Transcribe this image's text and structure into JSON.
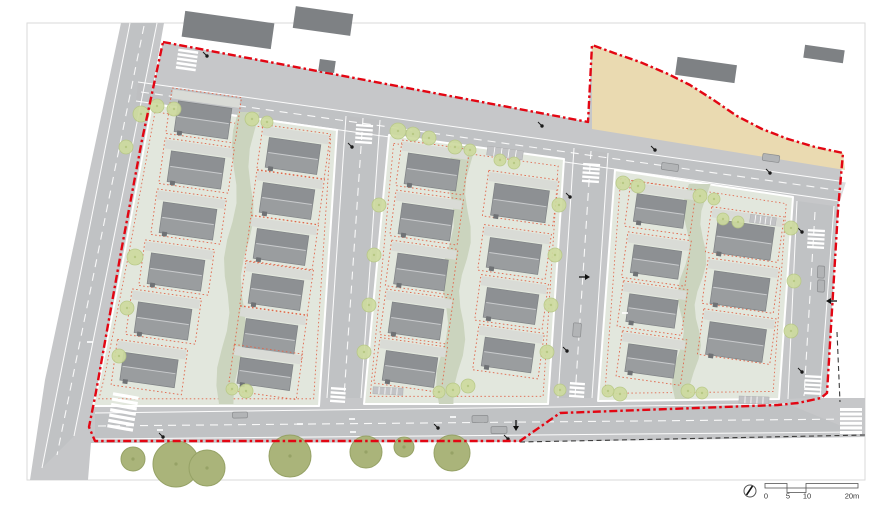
{
  "scale_bar": {
    "labels": [
      "0",
      "5",
      "10",
      "20m"
    ]
  },
  "colors": {
    "boundary_red": "#e30613",
    "plot_red": "#e0654a",
    "road_gray": "#c6c7c9",
    "carriageway_gray": "#bcbdbf",
    "block_green": "#e2e7dd",
    "path_green": "#cbd4be",
    "tree_green": "#cedb9f",
    "big_tree_green": "#aab47a",
    "beige": "#eadab1",
    "building_dark": "#7e8184",
    "driveway_gray": "#d9dbd6",
    "roof_upper": "#8d9093",
    "roof_lower": "#9a9d9f"
  },
  "plan": {
    "houses": [
      [
        203,
        120,
        54,
        31
      ],
      [
        196,
        170,
        54,
        31
      ],
      [
        188,
        221,
        54,
        31
      ],
      [
        176,
        272,
        54,
        31
      ],
      [
        163,
        321,
        54,
        31
      ],
      [
        149,
        370,
        55,
        28
      ],
      [
        293,
        156,
        52,
        30
      ],
      [
        287,
        201,
        52,
        30
      ],
      [
        281,
        247,
        52,
        30
      ],
      [
        276,
        292,
        52,
        30
      ],
      [
        270,
        337,
        52,
        30
      ],
      [
        265,
        374,
        53,
        26
      ],
      [
        432,
        172,
        52,
        31
      ],
      [
        426,
        222,
        52,
        31
      ],
      [
        421,
        272,
        51,
        31
      ],
      [
        416,
        321,
        52,
        31
      ],
      [
        410,
        369,
        52,
        30
      ],
      [
        520,
        203,
        55,
        32
      ],
      [
        514,
        256,
        52,
        30
      ],
      [
        511,
        306,
        52,
        30
      ],
      [
        508,
        355,
        50,
        29
      ],
      [
        660,
        211,
        50,
        28
      ],
      [
        656,
        262,
        48,
        28
      ],
      [
        652,
        311,
        49,
        28
      ],
      [
        651,
        361,
        49,
        28
      ],
      [
        744,
        240,
        57,
        33
      ],
      [
        740,
        291,
        56,
        33
      ],
      [
        736,
        342,
        57,
        33
      ]
    ],
    "trees": [
      [
        141,
        114,
        8
      ],
      [
        126,
        147,
        7
      ],
      [
        135,
        257,
        8
      ],
      [
        127,
        308,
        7
      ],
      [
        119,
        356,
        7
      ],
      [
        157,
        106,
        7
      ],
      [
        174,
        109,
        7
      ],
      [
        252,
        119,
        7
      ],
      [
        267,
        122,
        6
      ],
      [
        246,
        391,
        7
      ],
      [
        232,
        389,
        6
      ],
      [
        398,
        131,
        8
      ],
      [
        413,
        134,
        7
      ],
      [
        429,
        138,
        7
      ],
      [
        455,
        147,
        7
      ],
      [
        470,
        150,
        6
      ],
      [
        379,
        205,
        7
      ],
      [
        374,
        255,
        7
      ],
      [
        369,
        305,
        7
      ],
      [
        364,
        352,
        7
      ],
      [
        559,
        205,
        7
      ],
      [
        555,
        255,
        7
      ],
      [
        551,
        305,
        7
      ],
      [
        547,
        352,
        7
      ],
      [
        468,
        386,
        7
      ],
      [
        453,
        390,
        7
      ],
      [
        439,
        392,
        6
      ],
      [
        500,
        160,
        6
      ],
      [
        514,
        163,
        6
      ],
      [
        623,
        183,
        7
      ],
      [
        638,
        186,
        7
      ],
      [
        700,
        196,
        7
      ],
      [
        714,
        199,
        6
      ],
      [
        620,
        394,
        7
      ],
      [
        688,
        391,
        7
      ],
      [
        702,
        393,
        6
      ],
      [
        560,
        390,
        6
      ],
      [
        608,
        391,
        6
      ],
      [
        791,
        228,
        7
      ],
      [
        794,
        281,
        7
      ],
      [
        791,
        331,
        7
      ],
      [
        723,
        219,
        6
      ],
      [
        738,
        222,
        6
      ]
    ],
    "big_trees": [
      [
        133,
        459,
        12
      ],
      [
        176,
        464,
        23
      ],
      [
        207,
        468,
        18
      ],
      [
        290,
        456,
        21
      ],
      [
        366,
        452,
        16
      ],
      [
        404,
        447,
        10
      ],
      [
        452,
        453,
        18
      ]
    ],
    "lamps": [
      [
        207,
        56
      ],
      [
        542,
        126
      ],
      [
        655,
        150
      ],
      [
        770,
        173
      ],
      [
        802,
        232
      ],
      [
        802,
        372
      ],
      [
        570,
        197
      ],
      [
        567,
        351
      ],
      [
        508,
        439
      ],
      [
        163,
        437
      ],
      [
        438,
        428
      ],
      [
        352,
        147
      ]
    ],
    "cars": [
      [
        670,
        167,
        17,
        7,
        8
      ],
      [
        771,
        158,
        17,
        7,
        8
      ],
      [
        577,
        330,
        8,
        14,
        4
      ],
      [
        821,
        272,
        7,
        12,
        3
      ],
      [
        821,
        286,
        7,
        12,
        3
      ],
      [
        480,
        419,
        16,
        7,
        -1
      ],
      [
        499,
        430,
        16,
        7,
        -1
      ],
      [
        240,
        415,
        15,
        6,
        -1
      ]
    ],
    "crosswalks": [
      [
        187,
        60,
        5,
        20,
        2.6,
        4.4,
        8
      ],
      [
        364,
        134,
        5,
        17,
        2.4,
        4.2,
        4
      ],
      [
        591,
        173,
        5,
        17,
        2.4,
        4.2,
        4
      ],
      [
        816,
        239,
        5,
        17,
        2.4,
        4.2,
        3
      ],
      [
        813,
        385,
        5,
        17,
        2.4,
        4.2,
        3
      ],
      [
        338,
        395,
        4,
        15,
        2.4,
        4.2,
        4
      ],
      [
        577,
        390,
        4,
        15,
        2.4,
        4.2,
        4
      ],
      [
        123,
        412,
        7,
        26,
        3.2,
        5.4,
        10
      ],
      [
        851,
        421,
        6,
        22,
        3,
        4.6,
        0
      ]
    ],
    "hatches": [
      [
        505,
        153,
        36,
        9,
        8
      ],
      [
        763,
        220,
        26,
        8,
        8
      ],
      [
        754,
        400,
        30,
        7,
        2
      ],
      [
        388,
        391,
        30,
        7,
        3
      ]
    ],
    "marks": [
      [
        352,
        419
      ],
      [
        353,
        432
      ],
      [
        453,
        417
      ],
      [
        300,
        424
      ],
      [
        160,
        430
      ],
      [
        90,
        342
      ],
      [
        625,
        313
      ]
    ],
    "arrows": [
      [
        826,
        301,
        180
      ],
      [
        590,
        277,
        0
      ],
      [
        516,
        431,
        90
      ]
    ],
    "green_paths": [
      {
        "xt": 247,
        "yt": 112,
        "xb": 228,
        "yb": 404
      },
      {
        "xt": 463,
        "yt": 146,
        "xb": 448,
        "yb": 404
      },
      {
        "xt": 698,
        "yt": 184,
        "xb": 684,
        "yb": 399
      }
    ],
    "context_buildings": [
      [
        228,
        30,
        90,
        26
      ],
      [
        323,
        21,
        58,
        22
      ],
      [
        327,
        66,
        16,
        12
      ],
      [
        706,
        70,
        60,
        18
      ],
      [
        824,
        54,
        40,
        13
      ]
    ]
  }
}
